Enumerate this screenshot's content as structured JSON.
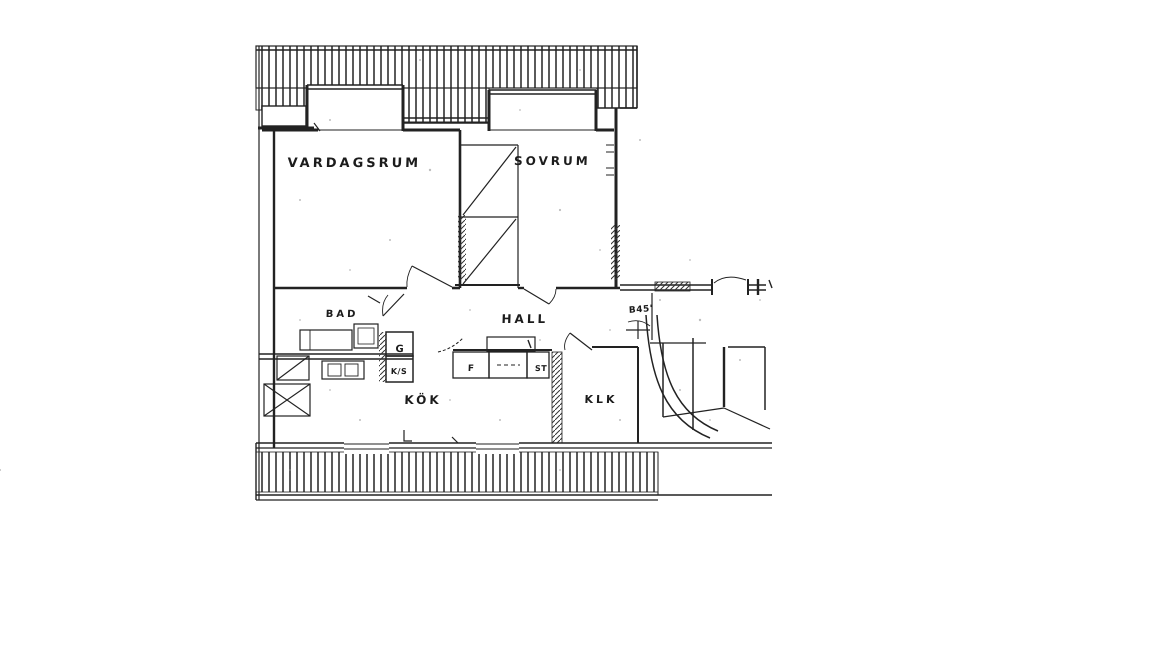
{
  "document": {
    "kind_label": "scanned apartment floor plan",
    "paper_color": "#ffffff",
    "ink_color": "#1c1c1c"
  },
  "rooms": {
    "vardagsrum": "VARDAGSRUM",
    "sovrum": "SOVRUM",
    "hall": "HALL",
    "bad": "BAD",
    "kok": "KÖK",
    "klk": "KLK"
  },
  "annotations": {
    "entry_label": "B45'",
    "closet_g": "G",
    "closet_ks": "K/S",
    "cabinet_f": "F",
    "cabinet_st": "ST"
  }
}
